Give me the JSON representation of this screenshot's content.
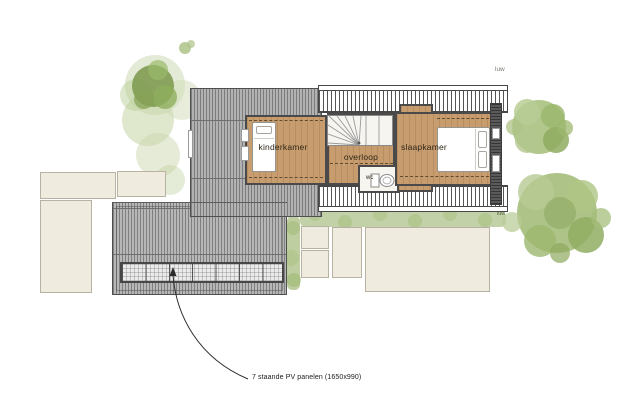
{
  "floorplan": {
    "rooms": [
      {
        "key": "kinderkamer",
        "label": "kinderkamer"
      },
      {
        "key": "overloop",
        "label": "overloop"
      },
      {
        "key": "wc",
        "label": "wc"
      },
      {
        "key": "slaapkamer",
        "label": "slaapkamer"
      }
    ],
    "annotations": {
      "pv_note": "7 staande PV panelen (1650x990)",
      "pv_panel_count": 7,
      "site_label_top": "luw",
      "site_label_hedge": "luw"
    },
    "icons": {
      "single_bed": "bed-icon",
      "double_bed": "double-bed-icon",
      "toilet": "toilet-icon",
      "stairs": "stairs-icon",
      "tree": "tree-icon",
      "pv_array": "solar-panel-icon",
      "leader": "arrow-leader-icon"
    },
    "colors": {
      "wood_floor": "#c79c6e",
      "wall": "#4a4a4a",
      "roof_gray": "#b7b7b7",
      "neighbor_fill": "#efecdf",
      "foliage_light": "#c4d3a4",
      "foliage_dark": "#7d9a4e",
      "hedge": "#b9cb9b",
      "background": "#ffffff"
    }
  }
}
